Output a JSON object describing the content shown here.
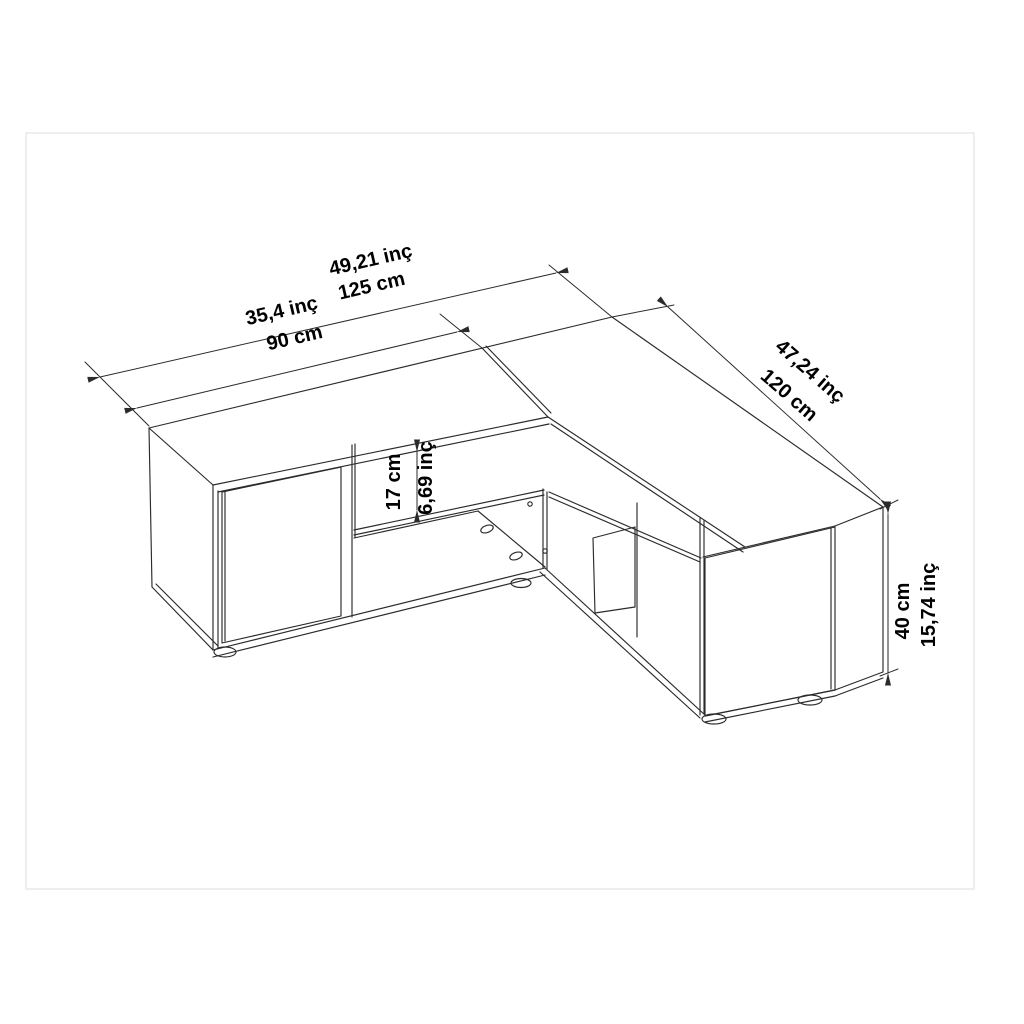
{
  "page": {
    "background": "#ffffff",
    "frame_color": "#e9e9e9",
    "line_color": "#2b2b2b",
    "text_color": "#000000"
  },
  "drawing": {
    "title": "L-shaped corner TV stand dimension drawing",
    "units": [
      "cm",
      "inç"
    ],
    "dimensions": [
      {
        "name": "top-length-total",
        "inch_label": "49,21 inç",
        "cm_label": "125 cm"
      },
      {
        "name": "top-length-left-section",
        "inch_label": "35,4 inç",
        "cm_label": "90 cm"
      },
      {
        "name": "right-wing-length",
        "inch_label": "47,24 inç",
        "cm_label": "120 cm"
      },
      {
        "name": "open-shelf-height",
        "inch_label": "6,69 inç",
        "cm_label": "17 cm"
      },
      {
        "name": "overall-height",
        "inch_label": "15,74 inç",
        "cm_label": "40 cm"
      }
    ]
  }
}
